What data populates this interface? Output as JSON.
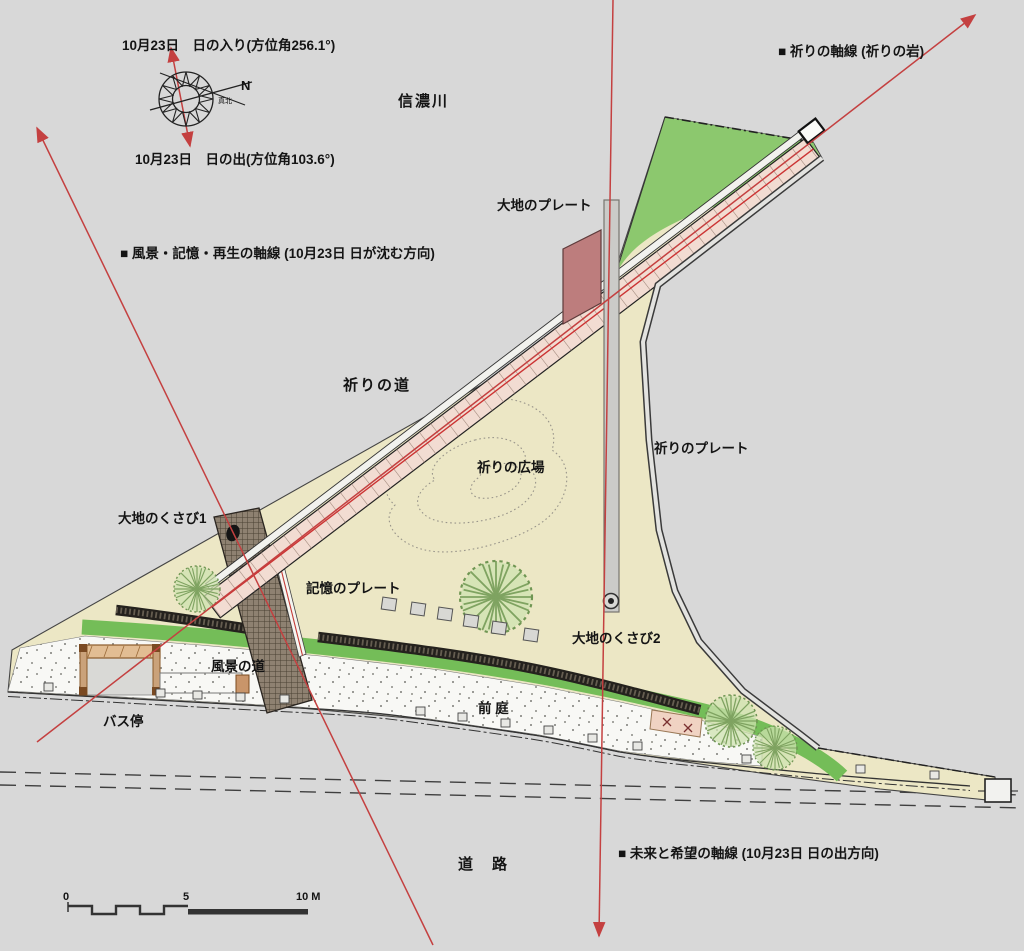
{
  "labels": {
    "sunset_line": "10月23日　日の入り(方位角256.1°)",
    "sunrise_line": "10月23日　日の出(方位角103.6°)",
    "prayer_axis": "■ 祈りの軸線 (祈りの岩)",
    "river": "信濃川",
    "earth_plate": "大地のプレート",
    "landscape_axis": "■ 風景・記憶・再生の軸線 (10月23日 日が沈む方向)",
    "prayer_path": "祈りの道",
    "prayer_plaza": "祈りの広場",
    "prayer_plate": "祈りのプレート",
    "earth_wedge1": "大地のくさび1",
    "memory_plate": "記憶のプレート",
    "landscape_path": "風景の道",
    "earth_wedge2": "大地のくさび2",
    "bus_stop": "バス停",
    "front_garden": "前 庭",
    "road": "道　路",
    "future_axis": "■ 未来と希望の軸線 (10月23日 日の出方向)",
    "compass_n": "N",
    "compass_true_north": "真北"
  },
  "scale_bar": {
    "zero": "0",
    "five": "5",
    "ten": "10 M"
  },
  "colors": {
    "background": "#d8d8d8",
    "site_fill": "#ece7c5",
    "lawn_green": "#8cc86e",
    "band_green": "#74bd58",
    "path_pink": "#f2dcd2",
    "plate_maroon": "#bd7d7d",
    "memory_band": "#8e8171",
    "axis_red": "#c44040",
    "wall_dark": "#24211d",
    "front_garden_fill": "#f8f8f5"
  }
}
